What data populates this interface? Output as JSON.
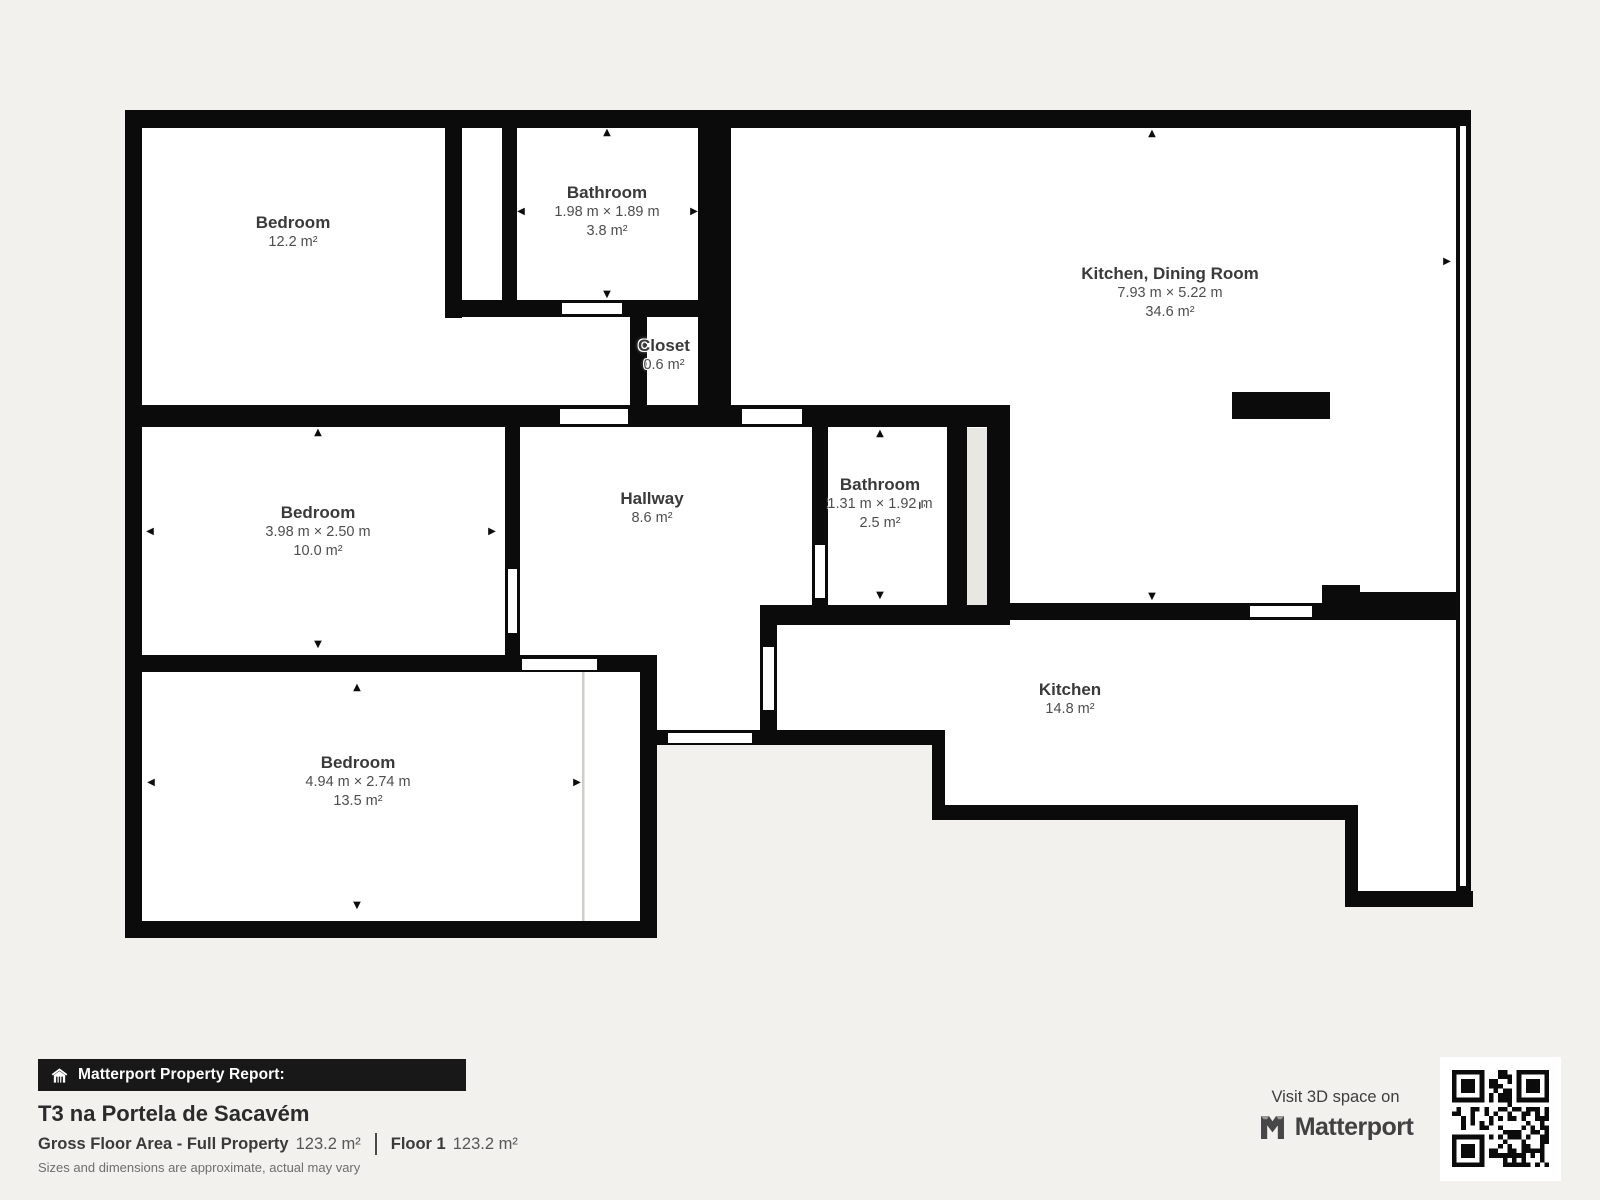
{
  "plan": {
    "rooms": [
      {
        "id": "bedroom-top-left",
        "name": "Bedroom",
        "area": "12.2 m²"
      },
      {
        "id": "bathroom-top",
        "name": "Bathroom",
        "dims": "1.98 m × 1.89 m",
        "area": "3.8 m²"
      },
      {
        "id": "kitchen-dining-room",
        "name": "Kitchen, Dining Room",
        "dims": "7.93 m × 5.22 m",
        "area": "34.6 m²"
      },
      {
        "id": "closet",
        "name": "Closet",
        "area": "0.6 m²"
      },
      {
        "id": "bedroom-middle-left",
        "name": "Bedroom",
        "dims": "3.98 m × 2.50 m",
        "area": "10.0 m²"
      },
      {
        "id": "hallway",
        "name": "Hallway",
        "area": "8.6 m²"
      },
      {
        "id": "bathroom-middle",
        "name": "Bathroom",
        "dims": "1.31 m × 1.92 m",
        "area": "2.5 m²"
      },
      {
        "id": "bedroom-bottom-left",
        "name": "Bedroom",
        "dims": "4.94 m × 2.74 m",
        "area": "13.5 m²"
      },
      {
        "id": "kitchen",
        "name": "Kitchen",
        "area": "14.8 m²"
      }
    ],
    "icons": {
      "arrow_up": "▲",
      "arrow_down": "▼",
      "arrow_left": "◀",
      "arrow_right": "▶"
    },
    "colors": {
      "wall": "#0b0b0b",
      "room": "#ffffff",
      "background": "#f2f1ee",
      "shaft": "#e8e7e4"
    }
  },
  "footer": {
    "banner_label": "Matterport Property Report:",
    "property_title": "T3 na Portela de Sacavém",
    "gross_floor_area_label": "Gross Floor Area - Full Property",
    "gross_floor_area_value": "123.2 m²",
    "floor_label": "Floor 1",
    "floor_value": "123.2 m²",
    "disclaimer": "Sizes and dimensions are approximate, actual may vary",
    "visit_text": "Visit 3D space on",
    "brand": "Matterport"
  }
}
